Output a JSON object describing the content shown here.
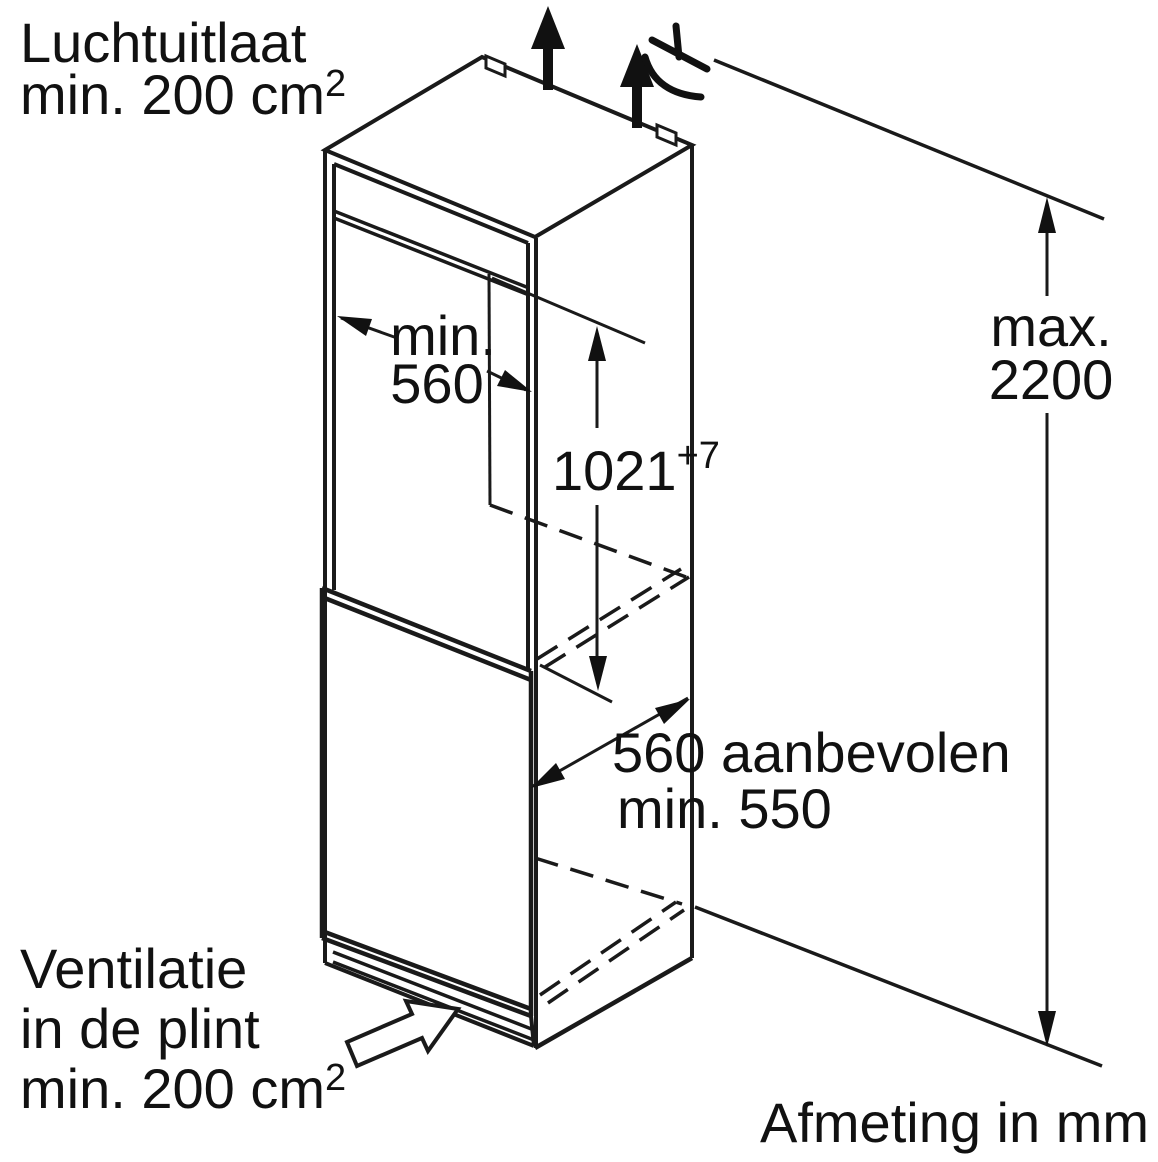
{
  "diagram": {
    "type": "appliance-installation-diagram",
    "unit_note": "Afmeting in mm",
    "colors": {
      "line": "#1a1a1a",
      "background": "#ffffff",
      "text": "#111111"
    },
    "labels": {
      "air_outlet": {
        "line1": "Luchtuitlaat",
        "line2": "min. 200 cm",
        "line2_sup": "2"
      },
      "plinth_vent": {
        "line1": "Ventilatie",
        "line2": "in de plint",
        "line3": "min. 200 cm",
        "line3_sup": "2"
      }
    },
    "dimensions": {
      "max_height": {
        "prefix": "max.",
        "value": "2200"
      },
      "niche_width": {
        "prefix": "min.",
        "value": "560"
      },
      "niche_height": {
        "value": "1021",
        "tolerance": "+7"
      },
      "depth": {
        "line1": "560 aanbevolen",
        "line2": "min. 550"
      }
    },
    "icons": {
      "airflow_top": "up-arrow",
      "power_cable": "mains-cable-symbol",
      "plinth_airflow": "hollow-up-right-arrow"
    }
  }
}
